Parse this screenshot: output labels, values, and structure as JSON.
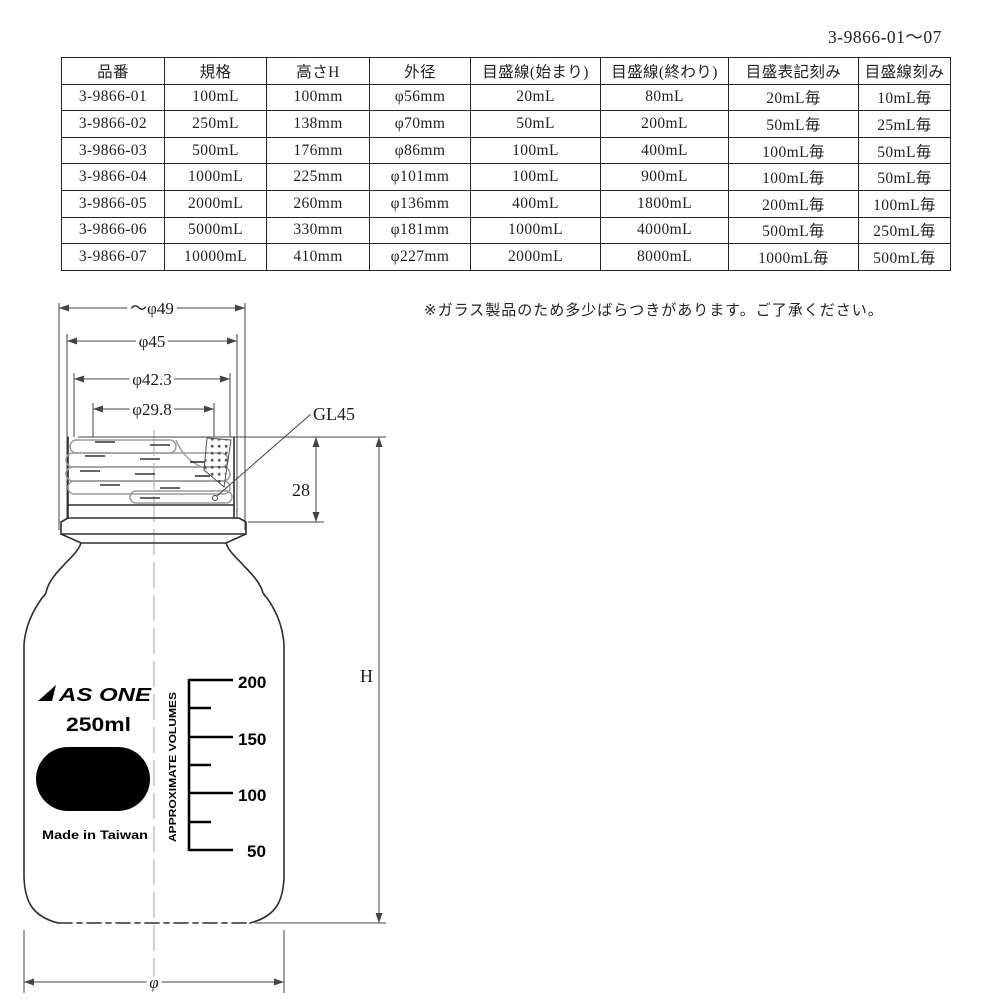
{
  "page_code": "3-9866-01～07",
  "note": "※ガラス製品のため多少ばらつきがあります。ご了承ください。",
  "table": {
    "headers": [
      "品番",
      "規格",
      "高さH",
      "外径",
      "目盛線(始まり)",
      "目盛線(終わり)",
      "目盛表記刻み",
      "目盛線刻み"
    ],
    "rows": [
      [
        "3-9866-01",
        "100mL",
        "100mm",
        "φ56mm",
        "20mL",
        "80mL",
        "20mL毎",
        "10mL毎"
      ],
      [
        "3-9866-02",
        "250mL",
        "138mm",
        "φ70mm",
        "50mL",
        "200mL",
        "50mL毎",
        "25mL毎"
      ],
      [
        "3-9866-03",
        "500mL",
        "176mm",
        "φ86mm",
        "100mL",
        "400mL",
        "100mL毎",
        "50mL毎"
      ],
      [
        "3-9866-04",
        "1000mL",
        "225mm",
        "φ101mm",
        "100mL",
        "900mL",
        "100mL毎",
        "50mL毎"
      ],
      [
        "3-9866-05",
        "2000mL",
        "260mm",
        "φ136mm",
        "400mL",
        "1800mL",
        "200mL毎",
        "100mL毎"
      ],
      [
        "3-9866-06",
        "5000mL",
        "330mm",
        "φ181mm",
        "1000mL",
        "4000mL",
        "500mL毎",
        "250mL毎"
      ],
      [
        "3-9866-07",
        "10000mL",
        "410mm",
        "φ227mm",
        "2000mL",
        "8000mL",
        "1000mL毎",
        "500mL毎"
      ]
    ]
  },
  "drawing": {
    "dims": {
      "cap_diameter": "～φ49",
      "outer_45": "φ45",
      "thread_42_3": "φ42.3",
      "mouth_29_8": "φ29.8",
      "thread_type": "GL45",
      "neck_height": "28",
      "total_height": "H",
      "body_diameter": "φ"
    },
    "label": {
      "brand": "AS ONE",
      "capacity": "250ml",
      "origin": "Made in Taiwan",
      "scale_title": "APPROXIMATE VOLUMES"
    },
    "scale_ticks": [
      "200",
      "150",
      "100",
      "50"
    ]
  }
}
